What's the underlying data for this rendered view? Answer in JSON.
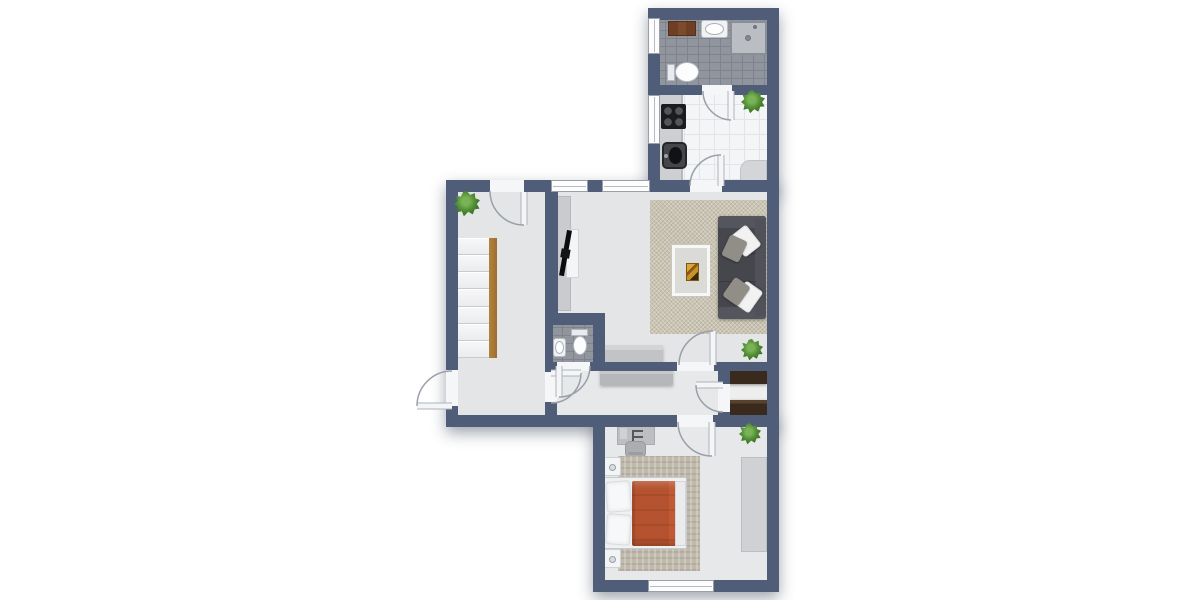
{
  "meta": {
    "type": "floor-plan-2d",
    "width": 1200,
    "height": 600,
    "background": "#ffffff"
  },
  "palette": {
    "wall": "#4f5d78",
    "floor_light": "#e4e5e7",
    "tile_dark": "#91959d",
    "tile_light": "#f4f5f7",
    "rug_living": "#cac4b3",
    "rug_bedroom": "#c0baac",
    "sofa": "#46474d",
    "duvet_red": "#b5522f",
    "wood_stair": "#a87937",
    "cabinet_brown": "#7d4b2b",
    "cabinet_dark_brown": "#3a2a1d",
    "plant_green": "#549238"
  },
  "shadow_blocks": [
    {
      "name": "block-top",
      "r": [
        648,
        8,
        131,
        184
      ]
    },
    {
      "name": "block-middle",
      "r": [
        446,
        180,
        333,
        247
      ]
    },
    {
      "name": "block-bottom",
      "r": [
        593,
        415,
        186,
        177
      ]
    }
  ],
  "floors": [
    {
      "name": "bathroom-floor",
      "surface": "tile-dark",
      "r": [
        654,
        14,
        119,
        75
      ]
    },
    {
      "name": "kitchen-floor",
      "surface": "tile-light",
      "r": [
        654,
        89,
        119,
        99
      ]
    },
    {
      "name": "living-room-floor",
      "surface": "plain-a",
      "r": [
        552,
        186,
        221,
        182
      ]
    },
    {
      "name": "stair-room-floor",
      "surface": "plain-a",
      "r": [
        452,
        186,
        99,
        235
      ]
    },
    {
      "name": "wc-floor",
      "surface": "tile-dark",
      "r": [
        551,
        319,
        48,
        47
      ]
    },
    {
      "name": "hallway-floor",
      "surface": "plain-b",
      "r": [
        551,
        366,
        173,
        55
      ]
    },
    {
      "name": "closet-floor",
      "surface": "plain-c",
      "r": [
        724,
        366,
        49,
        55
      ]
    },
    {
      "name": "bedroom-floor",
      "surface": "plain-b",
      "r": [
        599,
        421,
        174,
        165
      ]
    }
  ],
  "walls": [
    {
      "name": "wall-top",
      "r": [
        648,
        8,
        131,
        12
      ]
    },
    {
      "name": "wall-left-upper",
      "r": [
        648,
        8,
        12,
        174
      ]
    },
    {
      "name": "wall-right",
      "r": [
        767,
        8,
        12,
        584
      ]
    },
    {
      "name": "wall-bath-kitchen",
      "r": [
        660,
        85,
        107,
        10
      ]
    },
    {
      "name": "wall-top-main",
      "r": [
        446,
        180,
        321,
        12
      ]
    },
    {
      "name": "wall-stair-left",
      "r": [
        446,
        180,
        12,
        247
      ]
    },
    {
      "name": "wall-stair-living",
      "r": [
        545,
        186,
        13,
        127
      ]
    },
    {
      "name": "wall-wc-top",
      "r": [
        545,
        313,
        60,
        12
      ]
    },
    {
      "name": "wall-wc-right",
      "r": [
        593,
        313,
        12,
        58
      ]
    },
    {
      "name": "wall-wc-left",
      "r": [
        545,
        325,
        8,
        37
      ]
    },
    {
      "name": "wall-hall-top",
      "r": [
        545,
        362,
        222,
        9
      ]
    },
    {
      "name": "wall-stair-hall",
      "r": [
        545,
        371,
        12,
        56
      ]
    },
    {
      "name": "wall-bottom-left",
      "r": [
        446,
        415,
        159,
        12
      ]
    },
    {
      "name": "wall-closet",
      "r": [
        718,
        362,
        12,
        53
      ]
    },
    {
      "name": "wall-bedroom-top",
      "r": [
        593,
        415,
        174,
        12
      ]
    },
    {
      "name": "wall-bedroom-left",
      "r": [
        593,
        415,
        12,
        177
      ]
    },
    {
      "name": "wall-bedroom-bottom",
      "r": [
        593,
        580,
        174,
        12
      ]
    }
  ],
  "door_gaps": [
    {
      "name": "gap-stair-top-door",
      "r": [
        490,
        180,
        34,
        12
      ]
    },
    {
      "name": "gap-entrance-door",
      "r": [
        446,
        370,
        12,
        36
      ]
    },
    {
      "name": "gap-stair-hall-door",
      "r": [
        545,
        372,
        12,
        30
      ]
    },
    {
      "name": "gap-wc-door",
      "r": [
        557,
        362,
        33,
        9
      ]
    },
    {
      "name": "gap-living-door",
      "r": [
        677,
        362,
        37,
        9
      ]
    },
    {
      "name": "gap-kitchen-door",
      "r": [
        690,
        180,
        32,
        12
      ]
    },
    {
      "name": "gap-bathroom-door",
      "r": [
        702,
        85,
        30,
        10
      ]
    },
    {
      "name": "gap-closet-door",
      "r": [
        718,
        384,
        12,
        28
      ]
    },
    {
      "name": "gap-bedroom-door",
      "r": [
        677,
        415,
        36,
        12
      ]
    }
  ],
  "windows": [
    {
      "name": "bathroom-window",
      "orient": "v",
      "r": [
        648,
        18,
        12,
        36
      ]
    },
    {
      "name": "kitchen-window",
      "orient": "v",
      "r": [
        648,
        95,
        12,
        49
      ]
    },
    {
      "name": "living-window-1",
      "orient": "h",
      "r": [
        551,
        180,
        37,
        12
      ]
    },
    {
      "name": "living-window-2",
      "orient": "h",
      "r": [
        602,
        180,
        48,
        12
      ]
    },
    {
      "name": "bedroom-window",
      "orient": "h",
      "r": [
        648,
        580,
        66,
        12
      ]
    }
  ],
  "doors": [
    {
      "name": "stair-room-top-door",
      "arc": "M 490 191 A 34 34 0 0 0 524 225",
      "leaf": [
        524,
        192,
        524,
        225
      ]
    },
    {
      "name": "entrance-door",
      "arc": "M 452 371 A 35 35 0 0 0 417 406",
      "leaf": [
        452,
        406,
        417,
        406
      ]
    },
    {
      "name": "stair-hall-door",
      "arc": "M 581 373 A 30 30 0 0 1 551 403",
      "leaf": [
        551,
        373,
        581,
        373
      ]
    },
    {
      "name": "wc-door",
      "arc": "M 590 366 A 31 31 0 0 1 559 397",
      "leaf": [
        559,
        366,
        559,
        397
      ]
    },
    {
      "name": "living-room-door",
      "arc": "M 679 365 A 34 34 0 0 1 713 331",
      "leaf": [
        713,
        365,
        713,
        331
      ]
    },
    {
      "name": "kitchen-door",
      "arc": "M 690 186 A 31 31 0 0 1 721 155",
      "leaf": [
        721,
        186,
        721,
        155
      ]
    },
    {
      "name": "bathroom-door",
      "arc": "M 703 91 A 29 29 0 0 0 731 120",
      "leaf": [
        731,
        91,
        731,
        120
      ]
    },
    {
      "name": "closet-door",
      "arc": "M 696 385 A 27 27 0 0 0 723 412",
      "leaf": [
        723,
        385,
        696,
        385
      ]
    },
    {
      "name": "bedroom-door",
      "arc": "M 678 422 A 34 34 0 0 0 712 456",
      "leaf": [
        712,
        422,
        712,
        456
      ]
    }
  ],
  "stairs": {
    "name": "staircase",
    "x": 458,
    "y": 238,
    "w": 31,
    "h": 120,
    "steps": 7,
    "stringer": {
      "x": 489,
      "w": 8
    }
  },
  "furniture": [
    {
      "name": "bathroom-cabinet",
      "kind": "cabinet-brown",
      "r": [
        668,
        21,
        28,
        15
      ]
    },
    {
      "name": "bathroom-sink-counter",
      "kind": "sink-counter",
      "r": [
        701,
        20,
        27,
        18
      ]
    },
    {
      "name": "bathroom-sink-basin",
      "kind": "basin",
      "r": [
        705,
        23,
        19,
        12
      ]
    },
    {
      "name": "shower",
      "kind": "shower",
      "r": [
        730,
        21,
        37,
        34
      ]
    },
    {
      "name": "shower-drain",
      "kind": "drain",
      "r": [
        745,
        35,
        6,
        6
      ]
    },
    {
      "name": "bathroom-toilet-tank",
      "kind": "toilet-tank",
      "r": [
        667,
        64,
        8,
        17
      ]
    },
    {
      "name": "bathroom-toilet-bowl",
      "kind": "toilet-bowl",
      "r": [
        675,
        62,
        24,
        20
      ]
    },
    {
      "name": "kitchen-counter",
      "kind": "counter",
      "r": [
        659,
        89,
        24,
        93
      ]
    },
    {
      "name": "stove",
      "kind": "stove",
      "r": [
        661,
        104,
        25,
        25
      ]
    },
    {
      "name": "kitchen-sink",
      "kind": "ksink",
      "r": [
        662,
        142,
        25,
        27
      ]
    },
    {
      "name": "kitchen-corner-counter",
      "kind": "corner-counter",
      "r": [
        740,
        160,
        27,
        22
      ]
    },
    {
      "name": "living-rug",
      "kind": "rug-living",
      "r": [
        650,
        200,
        117,
        134
      ]
    },
    {
      "name": "tv-board",
      "kind": "tv-board",
      "r": [
        557,
        196,
        14,
        115
      ]
    },
    {
      "name": "tv-panel",
      "kind": "tv-panel",
      "r": [
        566,
        229,
        13,
        49
      ]
    },
    {
      "name": "tv",
      "kind": "tv",
      "r": [
        563,
        230,
        5,
        46
      ],
      "rot": 10
    },
    {
      "name": "sofa",
      "kind": "sofa-base",
      "r": [
        718,
        216,
        48,
        103
      ]
    },
    {
      "name": "sofa-armrest-top",
      "kind": "sofa-arm",
      "r": [
        718,
        216,
        48,
        12
      ]
    },
    {
      "name": "sofa-armrest-bottom",
      "kind": "sofa-arm",
      "r": [
        718,
        307,
        48,
        12
      ]
    },
    {
      "name": "sofa-backrest",
      "kind": "sofa-back",
      "r": [
        755,
        219,
        11,
        97
      ]
    },
    {
      "name": "sofa-seam-1",
      "kind": "seam",
      "r": [
        719,
        253,
        37,
        1
      ]
    },
    {
      "name": "sofa-seam-2",
      "kind": "seam",
      "r": [
        719,
        281,
        37,
        1
      ]
    },
    {
      "name": "sofa-pillow-white-1",
      "kind": "pillow-white",
      "r": [
        735,
        228,
        21,
        26
      ],
      "rot": -38
    },
    {
      "name": "sofa-pillow-gray-1",
      "kind": "pillow-gray",
      "r": [
        725,
        237,
        19,
        23
      ],
      "rot": 25
    },
    {
      "name": "sofa-pillow-white-2",
      "kind": "pillow-white",
      "r": [
        737,
        284,
        21,
        26
      ],
      "rot": -145
    },
    {
      "name": "sofa-pillow-gray-2",
      "kind": "pillow-gray",
      "r": [
        727,
        280,
        19,
        23
      ],
      "rot": 35
    },
    {
      "name": "coffee-table",
      "kind": "coffee-table",
      "r": [
        672,
        245,
        38,
        51
      ]
    },
    {
      "name": "coffee-table-art",
      "kind": "art",
      "r": [
        686,
        263,
        13,
        18
      ]
    },
    {
      "name": "living-sideboard",
      "kind": "sideboard",
      "r": [
        598,
        345,
        65,
        17
      ]
    },
    {
      "name": "wc-sink-counter",
      "kind": "sink-counter",
      "r": [
        553,
        338,
        13,
        19
      ]
    },
    {
      "name": "wc-sink-basin",
      "kind": "basin",
      "r": [
        555,
        341,
        9,
        13
      ]
    },
    {
      "name": "wc-toilet-tank",
      "kind": "toilet-tank",
      "r": [
        571,
        329,
        17,
        7
      ]
    },
    {
      "name": "wc-toilet-bowl",
      "kind": "toilet-bowl",
      "r": [
        573,
        336,
        14,
        19
      ]
    },
    {
      "name": "hallway-sideboard",
      "kind": "sideboard2",
      "r": [
        600,
        368,
        73,
        17
      ]
    },
    {
      "name": "closet-cabinet-1",
      "kind": "cabinet-dark",
      "r": [
        728,
        367,
        39,
        17
      ]
    },
    {
      "name": "closet-cabinet-2",
      "kind": "cabinet-dark",
      "r": [
        727,
        400,
        40,
        16
      ]
    },
    {
      "name": "desk",
      "kind": "desk",
      "r": [
        617,
        425,
        38,
        20
      ]
    },
    {
      "name": "desk-chair",
      "kind": "chair",
      "r": [
        625,
        441,
        21,
        17
      ]
    },
    {
      "name": "bedroom-rug",
      "kind": "rug-bedroom",
      "r": [
        618,
        456,
        82,
        115
      ]
    },
    {
      "name": "wardrobe",
      "kind": "wardrobe",
      "r": [
        741,
        457,
        26,
        95
      ]
    },
    {
      "name": "bed",
      "kind": "bed-base",
      "r": [
        602,
        477,
        85,
        72
      ]
    },
    {
      "name": "bed-pillow-1",
      "kind": "pillow-bed",
      "r": [
        606,
        481,
        25,
        31
      ],
      "rot": -4
    },
    {
      "name": "bed-pillow-2",
      "kind": "pillow-bed",
      "r": [
        606,
        514,
        25,
        31
      ],
      "rot": 4
    },
    {
      "name": "bed-duvet",
      "kind": "duvet",
      "r": [
        632,
        481,
        46,
        65
      ]
    },
    {
      "name": "bed-sheet-fold",
      "kind": "sheet",
      "r": [
        675,
        481,
        11,
        65
      ]
    },
    {
      "name": "nightstand-1",
      "kind": "nightstand",
      "r": [
        602,
        457,
        19,
        19
      ]
    },
    {
      "name": "nightstand-2",
      "kind": "nightstand",
      "r": [
        602,
        549,
        19,
        19
      ]
    }
  ],
  "plants": [
    {
      "name": "stair-room-plant",
      "cx": 467,
      "cy": 204,
      "r": 13
    },
    {
      "name": "kitchen-plant",
      "cx": 753,
      "cy": 102,
      "r": 12
    },
    {
      "name": "living-room-plant",
      "cx": 752,
      "cy": 350,
      "r": 11
    },
    {
      "name": "bedroom-plant",
      "cx": 750,
      "cy": 434,
      "r": 11
    }
  ]
}
